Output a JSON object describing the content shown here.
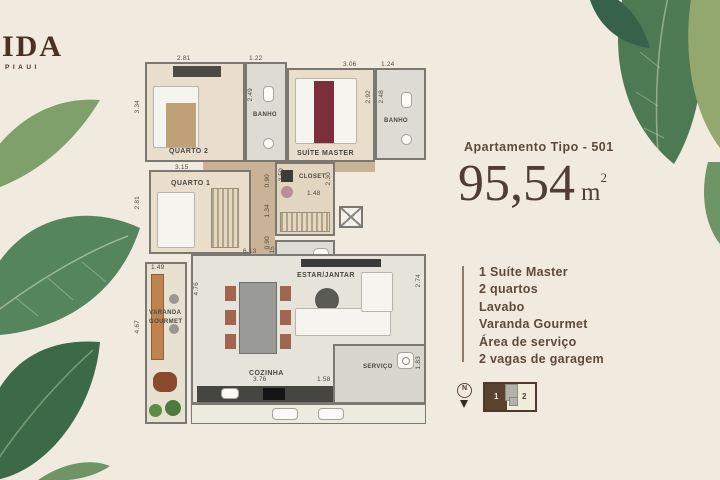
{
  "colors": {
    "background": "#f1ebdf",
    "brand_brown": "#5b4a3a",
    "leaf_dark": "#3c6a49",
    "leaf_mid": "#55855c",
    "leaf_light": "#8fae85"
  },
  "logo": {
    "title": "IDA",
    "subtitle": "PIAUI"
  },
  "info": {
    "apartment_label": "Apartamento Tipo - 501",
    "area_value": "95,54",
    "area_unit_base": "m",
    "area_unit_exponent": "2",
    "features": [
      "1 Suíte Master",
      "2 quartos",
      "Lavabo",
      "Varanda Gourmet",
      "Área de serviço",
      "2 vagas de garagem"
    ],
    "compass_letter": "N",
    "keyplan": {
      "unit1_label": "1",
      "unit2_label": "2"
    }
  },
  "plan": {
    "rooms": {
      "quarto2": {
        "label": "QUARTO 2",
        "width": "2.81",
        "height": "3.34"
      },
      "banho1": {
        "label": "BANHO",
        "width": "1.22",
        "height": "2.49"
      },
      "suite_master": {
        "label": "SUÍTE MASTER",
        "width": "3.06",
        "height": "2.92"
      },
      "banho2": {
        "label": "BANHO",
        "width": "1.24",
        "height": "2.48"
      },
      "quarto1": {
        "label": "QUARTO 1",
        "width": "3.15",
        "height": "2.81"
      },
      "closet": {
        "label": "CLOSET",
        "width": "1.48",
        "height_left": "2.50",
        "height_right": "2.30"
      },
      "lavabo": {
        "label": "LAVABO",
        "width": "1.80",
        "height": "1.15"
      },
      "varanda": {
        "label_line1": "VARANDA",
        "label_line2": "GOURMET",
        "width": "1.49",
        "height": "4.67"
      },
      "estar": {
        "label": "ESTAR/JANTAR",
        "height": "2.74"
      },
      "cozinha": {
        "label": "COZINHA",
        "width": "6.13",
        "height": "4.76",
        "counter_width": "3.76"
      },
      "servico": {
        "label": "SERVIÇO",
        "width": "1.58",
        "height": "1.83"
      }
    },
    "hall_dims": {
      "d1": "0.90",
      "d2": "1.34",
      "d3": "0.90"
    }
  }
}
